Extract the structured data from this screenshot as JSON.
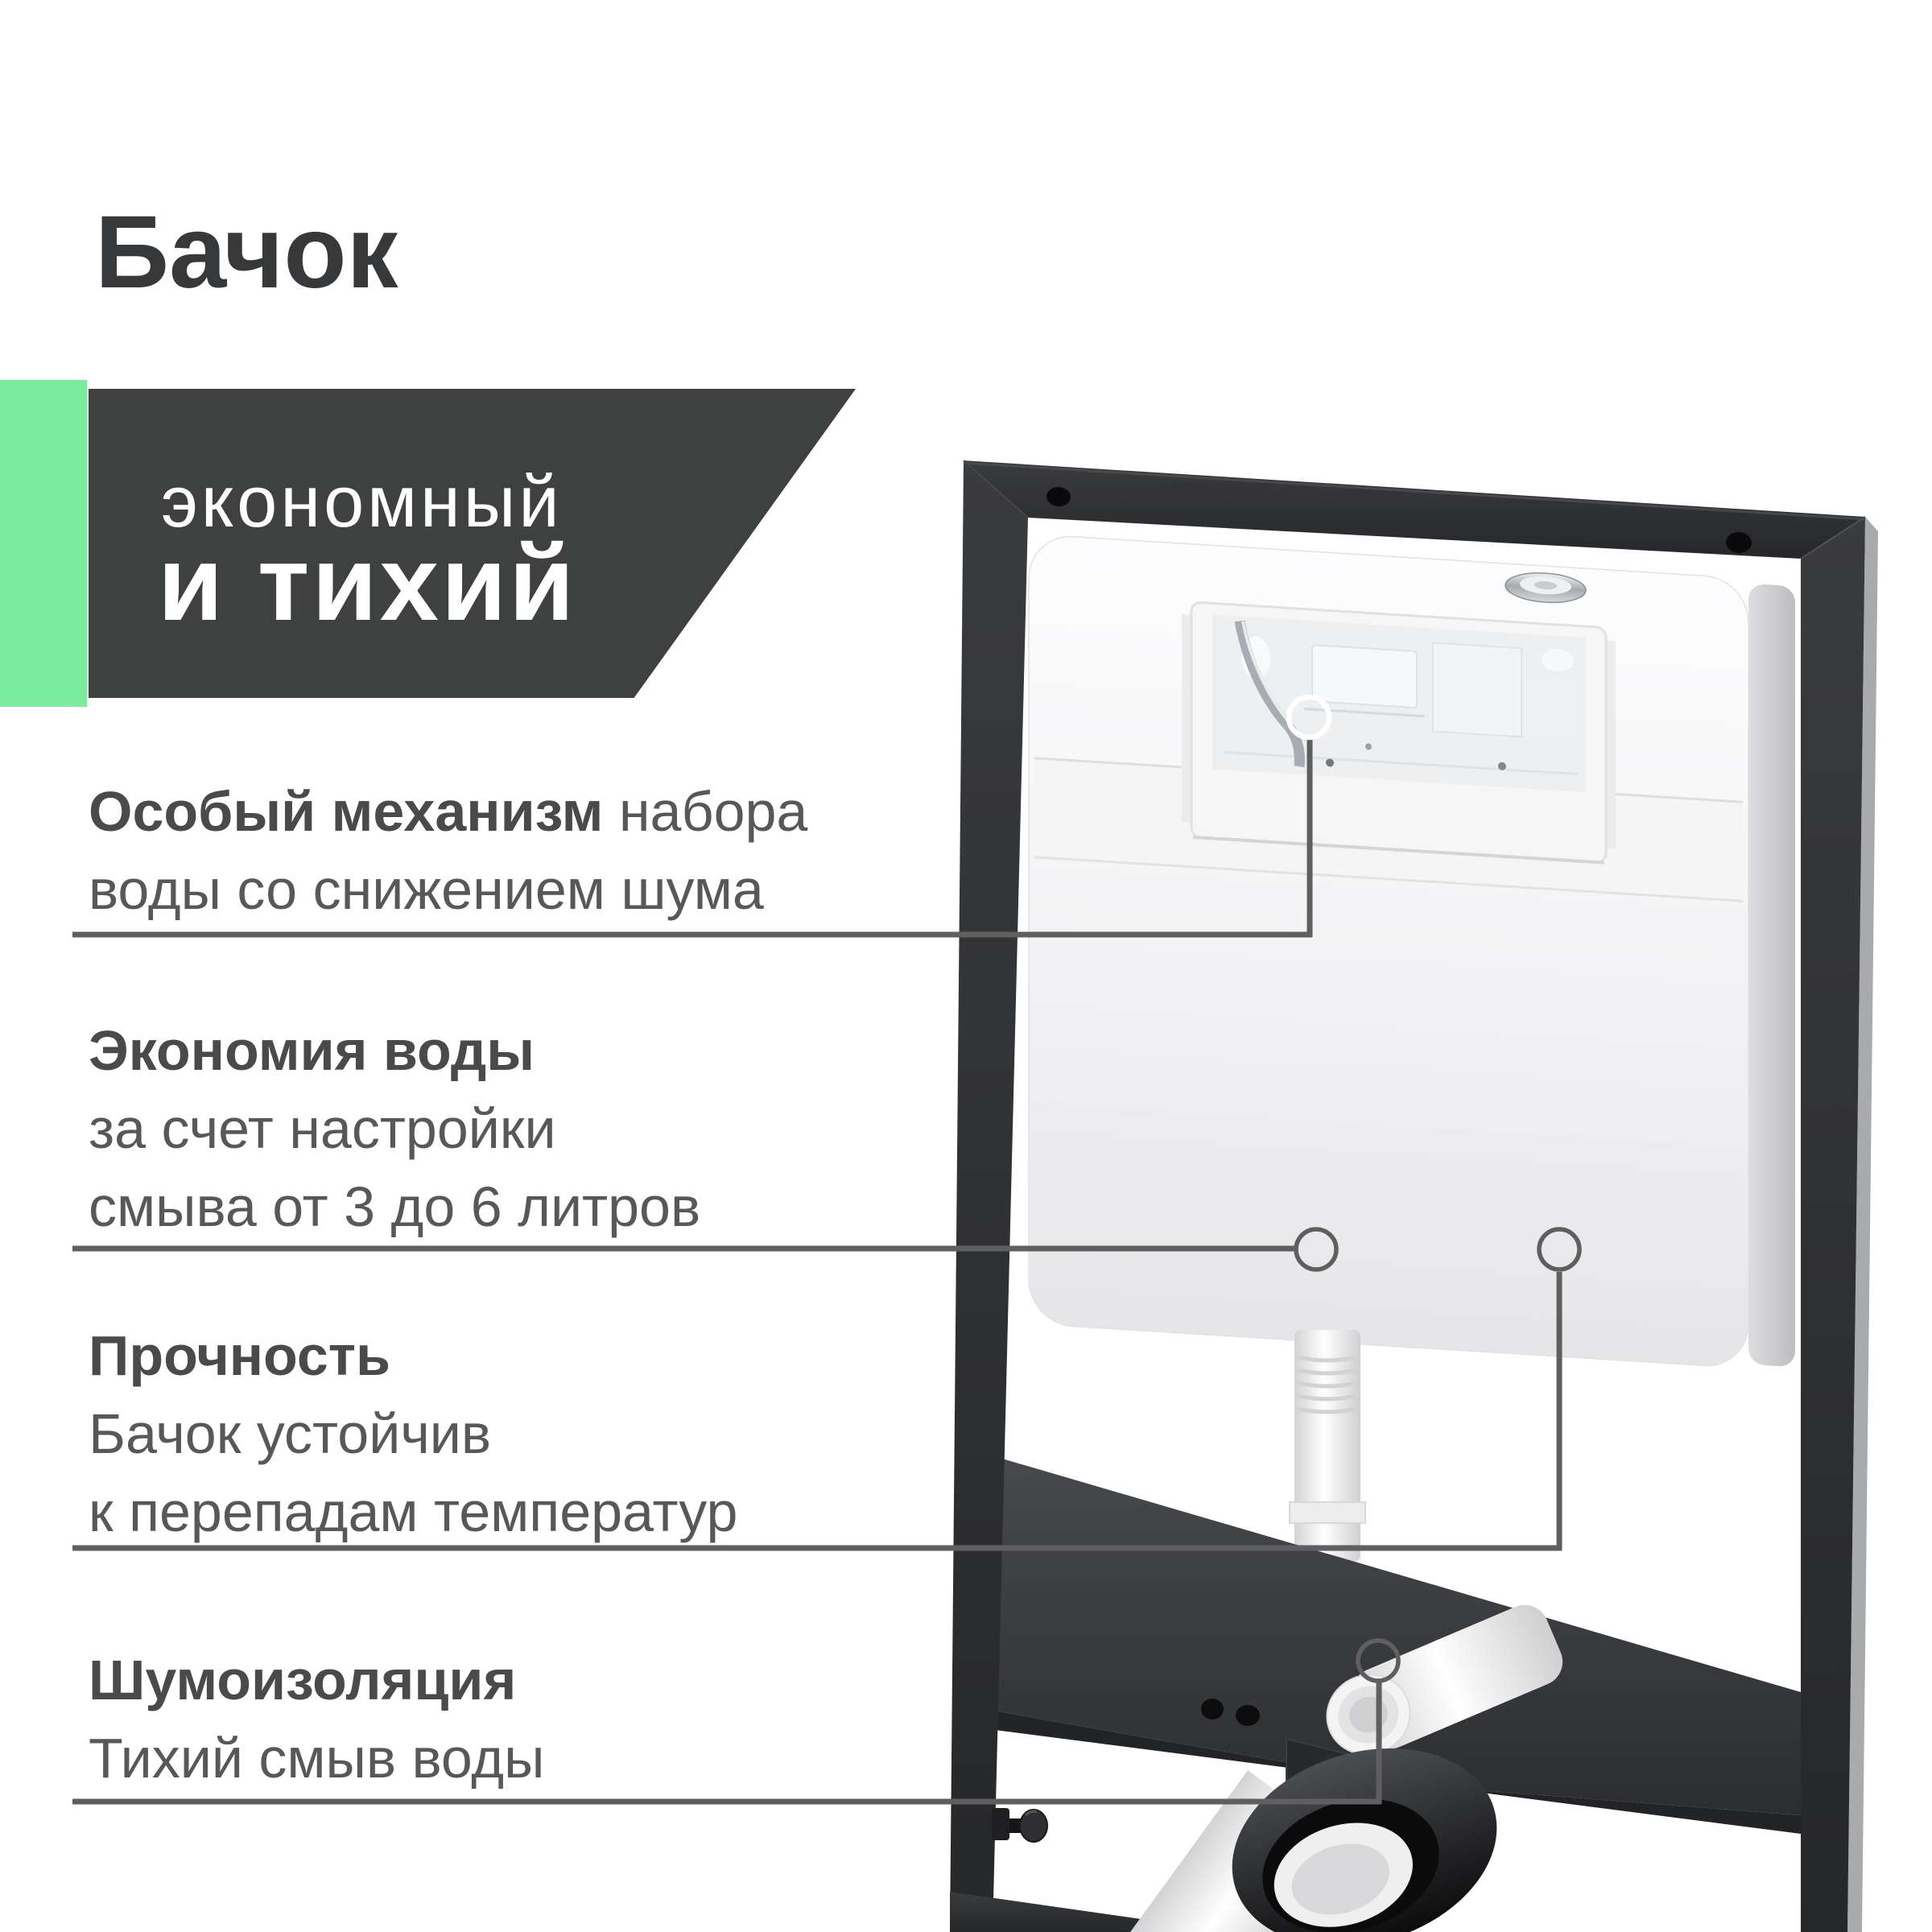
{
  "page": {
    "title": "Бачок"
  },
  "banner": {
    "line1": "экономный",
    "line2": "и тихий"
  },
  "features": [
    {
      "bold": "Особый механизм",
      "rest": " набора\nводы со снижением шума"
    },
    {
      "bold": "Экономия воды",
      "rest": "\nза счет настройки\nсмыва от 3 до 6 литров"
    },
    {
      "bold": "Прочность",
      "rest": "\nБачок устойчив\nк перепадам температур"
    },
    {
      "bold": "Шумоизоляция",
      "rest": "\nТихий смыв воды"
    }
  ],
  "product": {
    "items": [
      "installation-frame",
      "concealed-cistern",
      "flush-mechanism-window",
      "filler-cap",
      "flush-pipe",
      "drain-elbow",
      "sound-insulation-panel",
      "drain-collar",
      "adjuster-bolt"
    ]
  },
  "colors": {
    "accent": "#7bec9e",
    "banner-bg": "#3f4040",
    "banner-text": "#ffffff",
    "title-text": "#37383a",
    "feature-text": "#58585a",
    "feature-bold": "#4a4a4c",
    "callout": "#5f5f60",
    "bg": "#ffffff"
  }
}
